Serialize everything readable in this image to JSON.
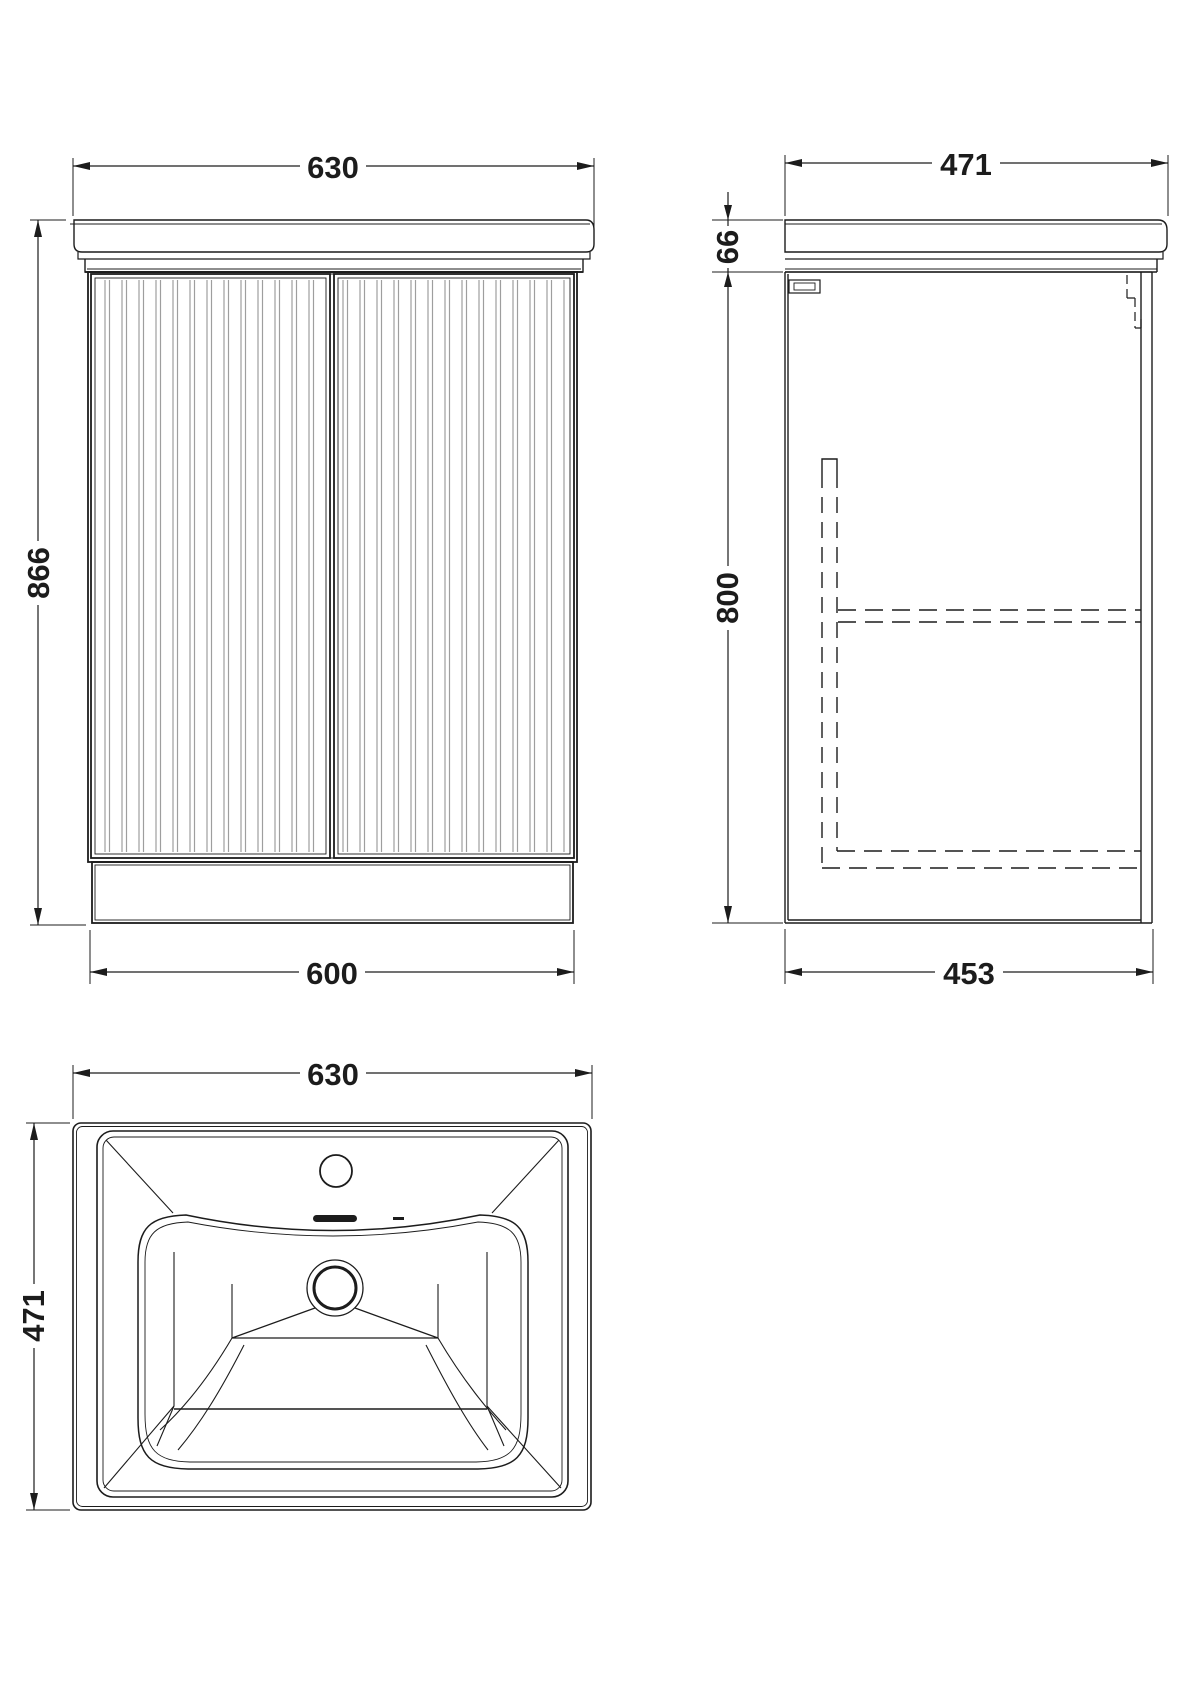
{
  "front": {
    "dims": {
      "top_width": "630",
      "height": "866",
      "bottom_width": "600"
    }
  },
  "side": {
    "dims": {
      "top_depth": "471",
      "worktop_height": "66",
      "cabinet_height": "800",
      "bottom_depth": "453"
    }
  },
  "basin": {
    "dims": {
      "width": "630",
      "depth": "471"
    }
  },
  "colors": {
    "line": "#1c1c1c",
    "flute": "#9e9e9e",
    "background": "#ffffff"
  }
}
